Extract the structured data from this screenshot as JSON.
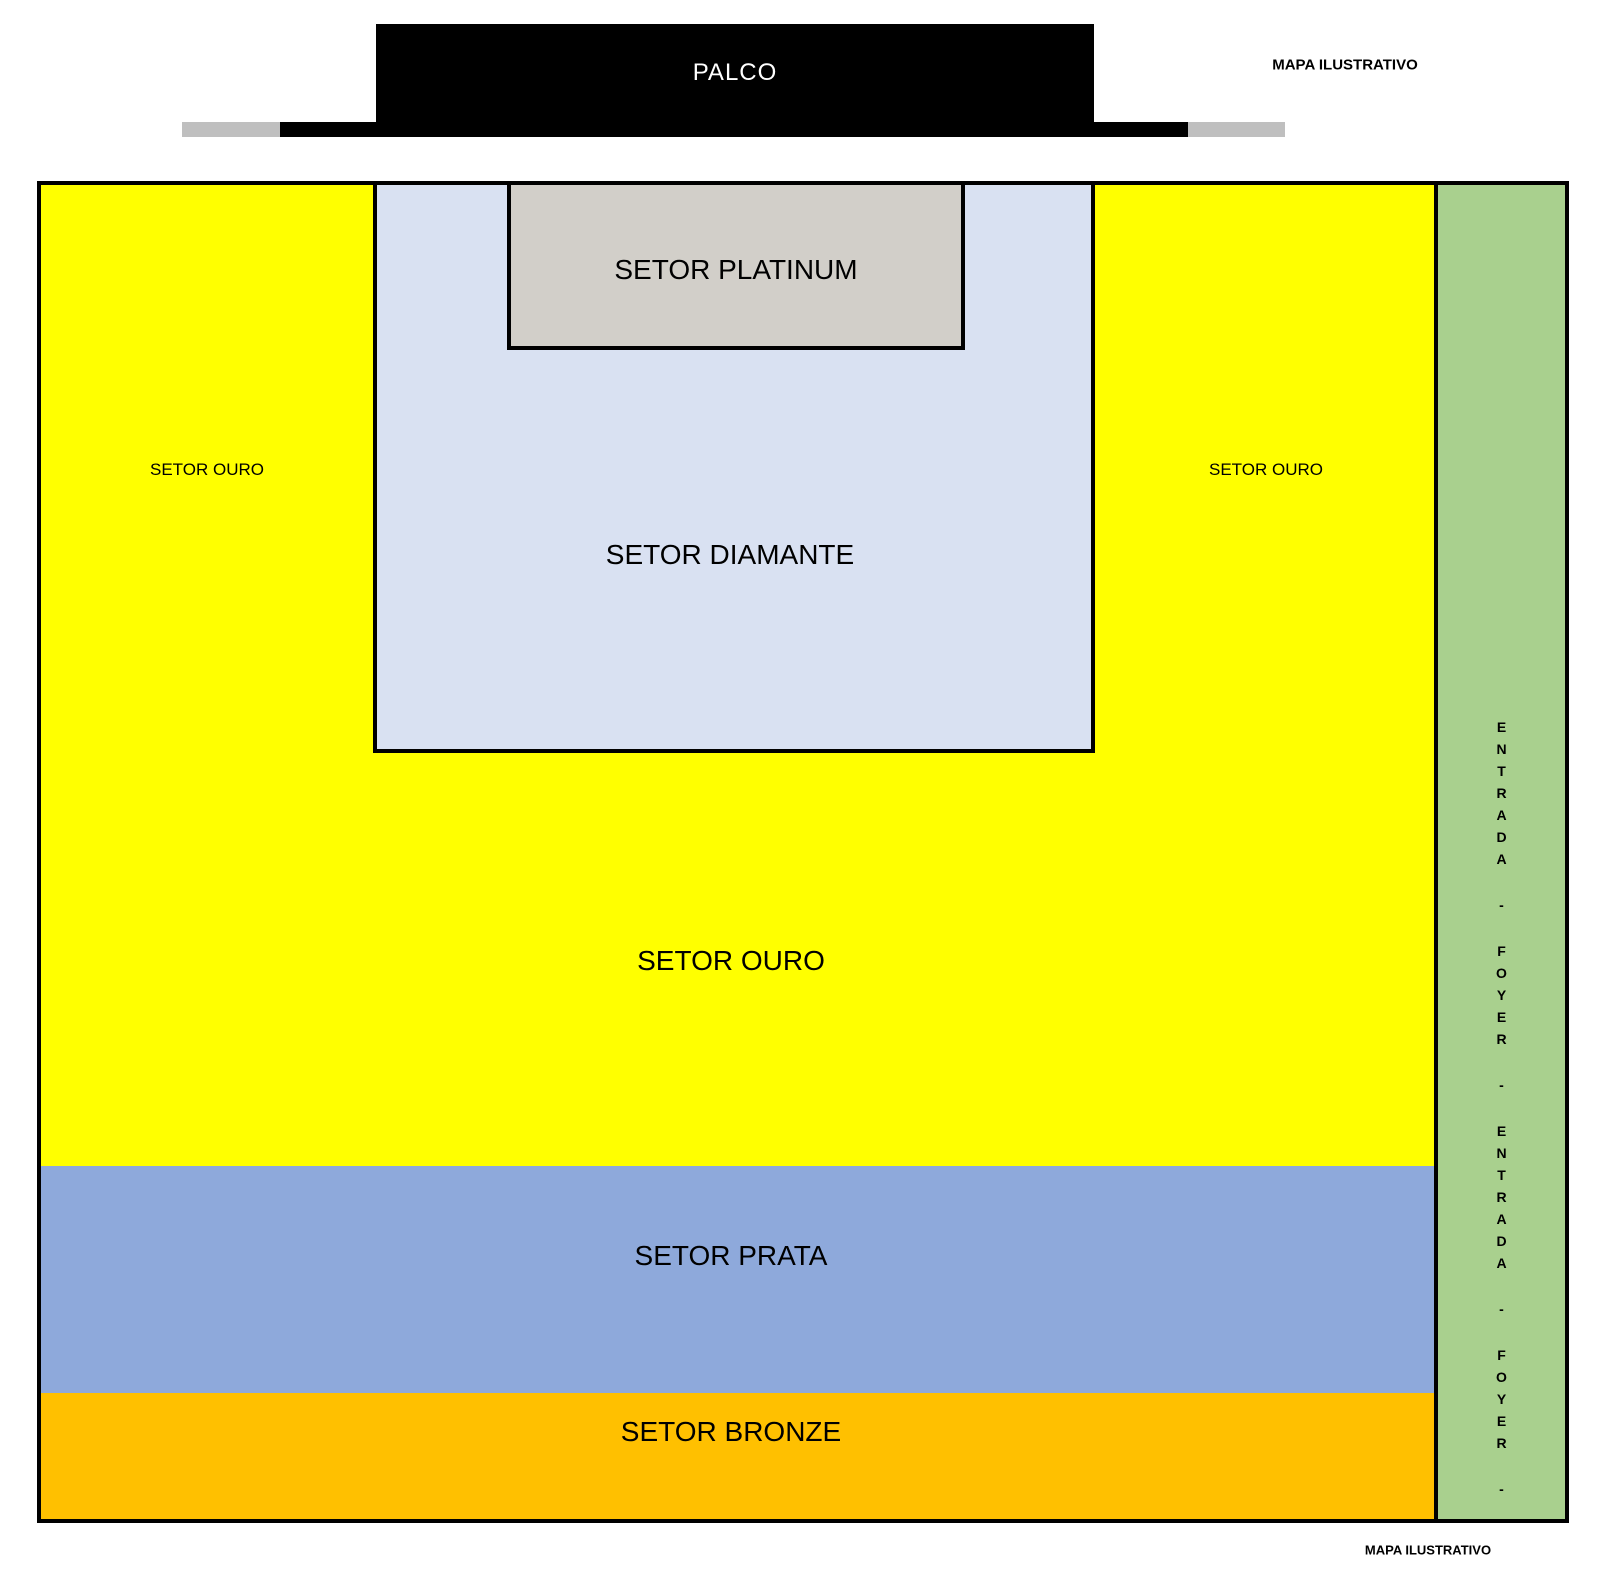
{
  "notes": {
    "top": "MAPA ILUSTRATIVO",
    "bottom": "MAPA ILUSTRATIVO"
  },
  "stage": {
    "label": "PALCO",
    "color": "#000000",
    "apron_color": "#000000",
    "wing_color": "#BFBFBF"
  },
  "sectors": {
    "platinum": {
      "label": "SETOR PLATINUM",
      "color": "#D2CFC9"
    },
    "diamante": {
      "label": "SETOR DIAMANTE",
      "color": "#D9E1F2"
    },
    "ouro": {
      "label": "SETOR OURO",
      "color": "#FFFF00"
    },
    "ouro_left": {
      "label": "SETOR OURO"
    },
    "ouro_right": {
      "label": "SETOR OURO"
    },
    "prata": {
      "label": "SETOR PRATA",
      "color": "#8EA9DB"
    },
    "bronze": {
      "label": "SETOR BRONZE",
      "color": "#FFC000"
    }
  },
  "entrance_strip": {
    "color": "#A9D08E",
    "label": "ENTRADA - FOYER - ENTRADA - FOYER -",
    "letters": [
      "E",
      "N",
      "T",
      "R",
      "A",
      "D",
      "A",
      "-",
      "F",
      "O",
      "Y",
      "E",
      "R",
      "-",
      "E",
      "N",
      "T",
      "R",
      "A",
      "D",
      "A",
      "-",
      "F",
      "O",
      "Y",
      "E",
      "R",
      "-"
    ]
  },
  "border_color": "#000000"
}
